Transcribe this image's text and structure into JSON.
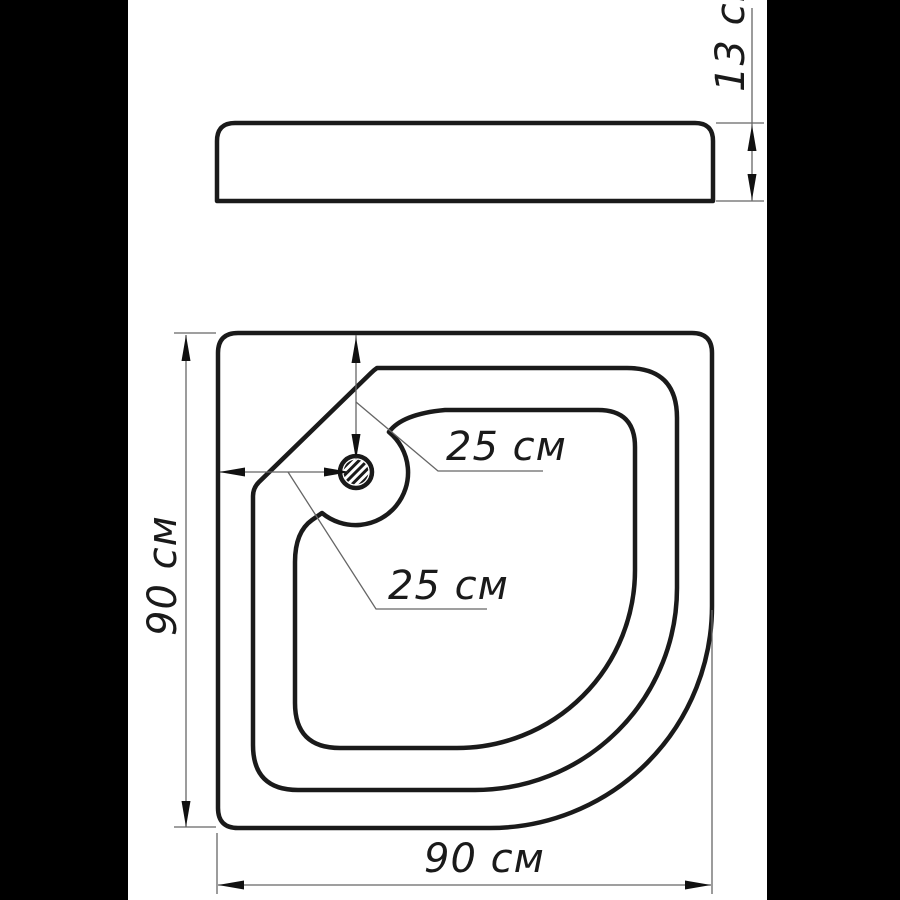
{
  "drawing": {
    "kind": "shower-tray-technical-drawing",
    "unit": "см",
    "labels": {
      "side_height": "13 см",
      "plan_height": "90 см",
      "plan_width": "90 см",
      "drain_offset_vertical": "25 см",
      "drain_offset_horizontal": "25 см"
    },
    "colors": {
      "letterbox": "#000000",
      "paper": "#ffffff",
      "contour_line": "#1a1a1a",
      "dimension_line": "#666666"
    }
  }
}
